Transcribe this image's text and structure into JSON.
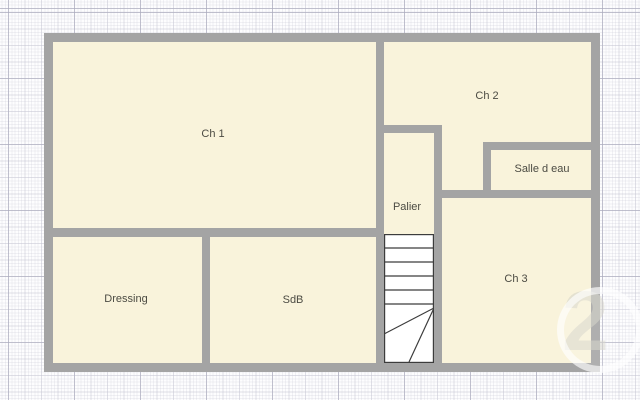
{
  "floor_plan": {
    "rooms": {
      "ch1": {
        "label": "Ch 1"
      },
      "ch2": {
        "label": "Ch 2"
      },
      "salle_d_eau": {
        "label": "Salle d eau"
      },
      "palier": {
        "label": "Palier"
      },
      "ch3": {
        "label": "Ch 3"
      },
      "dressing": {
        "label": "Dressing"
      },
      "sdb": {
        "label": "SdB"
      }
    },
    "watermark": {
      "glyph": "2"
    },
    "colors": {
      "wall": "#a4a4a4",
      "room_fill": "#f9f3db",
      "label_text": "#4c4b43",
      "stair_fill": "#ffffff",
      "stair_line": "#3c3c3c",
      "grid_major": "#aaaabc",
      "grid_medium": "#c4c4d2",
      "grid_minor": "#cdcdda",
      "page_background": "#fdfdfe"
    }
  }
}
